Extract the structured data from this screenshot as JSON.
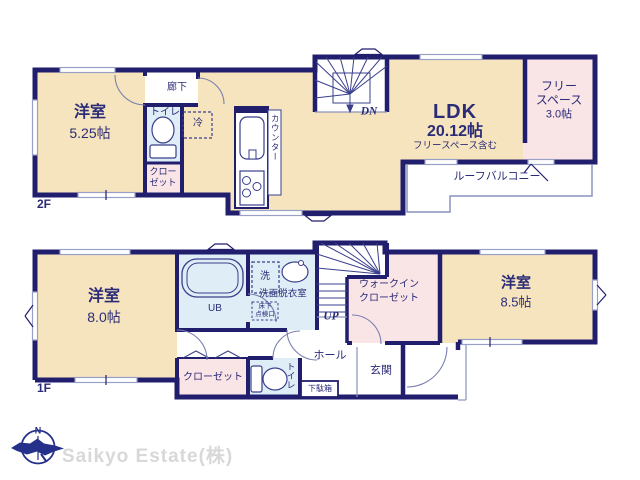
{
  "colors": {
    "wall_navy": "#221e6e",
    "floor_cream": "#f5e4bd",
    "room_pink": "#f9e4e6",
    "room_blue": "#dfeef6",
    "text_navy": "#2b2b78",
    "logo_gray": "#d8d8d8"
  },
  "floor2": {
    "floor_label": "2F",
    "bedroom": {
      "name": "洋室",
      "size": "5.25帖"
    },
    "corridor": "廊下",
    "toilet": "トイレ",
    "closet": {
      "line1": "クロー",
      "line2": "ゼット"
    },
    "fridge": "冷",
    "counter": "カウンター",
    "stairs_dn": "DN",
    "ldk": {
      "name": "LDK",
      "size": "20.12帖",
      "note": "フリースペース含む"
    },
    "free_space": {
      "line1": "フリー",
      "line2": "スペース",
      "size": "3.0帖"
    },
    "roof_balcony": "ルーフバルコニー"
  },
  "floor1": {
    "floor_label": "1F",
    "bedroom1": {
      "name": "洋室",
      "size": "8.0帖"
    },
    "unit_bath": "UB",
    "washer": "洗",
    "washroom": "洗面脱衣室",
    "floor_hatch": {
      "line1": "床下",
      "line2": "点検口"
    },
    "stairs_up": "UP",
    "wic": {
      "line1": "ウォークイン",
      "line2": "クローゼット"
    },
    "bedroom2": {
      "name": "洋室",
      "size": "8.5帖"
    },
    "hall": "ホール",
    "entrance": "玄関",
    "shoe_box": "下駄箱",
    "toilet": "トイレ",
    "closet": "クローゼット"
  },
  "footer": {
    "compass_north": "N",
    "company": "Saikyo Estate(株)"
  }
}
